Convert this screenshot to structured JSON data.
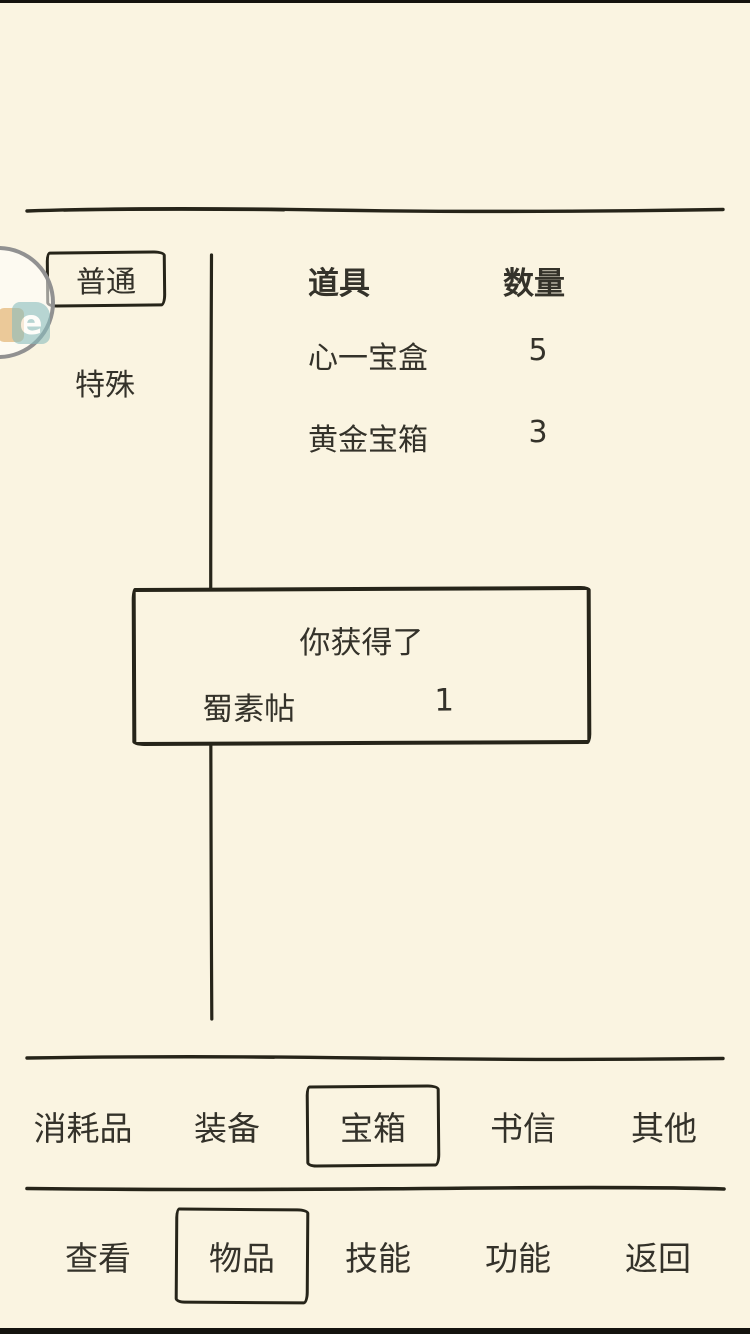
{
  "theme": {
    "background": "#faf4e1",
    "ink": "#262419",
    "text": "#34322a",
    "badge_ring": "#919191",
    "badge_orange": "#dfa85f",
    "badge_teal": "#8abdbe"
  },
  "sidebar": {
    "items": [
      {
        "label": "普通",
        "selected": true
      },
      {
        "label": "特殊",
        "selected": false
      }
    ]
  },
  "inventory": {
    "item_header": "道具",
    "qty_header": "数量",
    "rows": [
      {
        "name": "心一宝盒",
        "qty": "5"
      },
      {
        "name": "黄金宝箱",
        "qty": "3"
      }
    ]
  },
  "reward_popup": {
    "title": "你获得了",
    "item_name": "蜀素帖",
    "item_qty": "1"
  },
  "category_tabs": {
    "items": [
      {
        "label": "消耗品",
        "selected": false
      },
      {
        "label": "装备",
        "selected": false
      },
      {
        "label": "宝箱",
        "selected": true
      },
      {
        "label": "书信",
        "selected": false
      },
      {
        "label": "其他",
        "selected": false
      }
    ]
  },
  "bottom_nav": {
    "items": [
      {
        "label": "查看",
        "selected": false
      },
      {
        "label": "物品",
        "selected": true
      },
      {
        "label": "技能",
        "selected": false
      },
      {
        "label": "功能",
        "selected": false
      },
      {
        "label": "返回",
        "selected": false
      }
    ]
  },
  "floating_badge": {
    "letter": "e"
  }
}
